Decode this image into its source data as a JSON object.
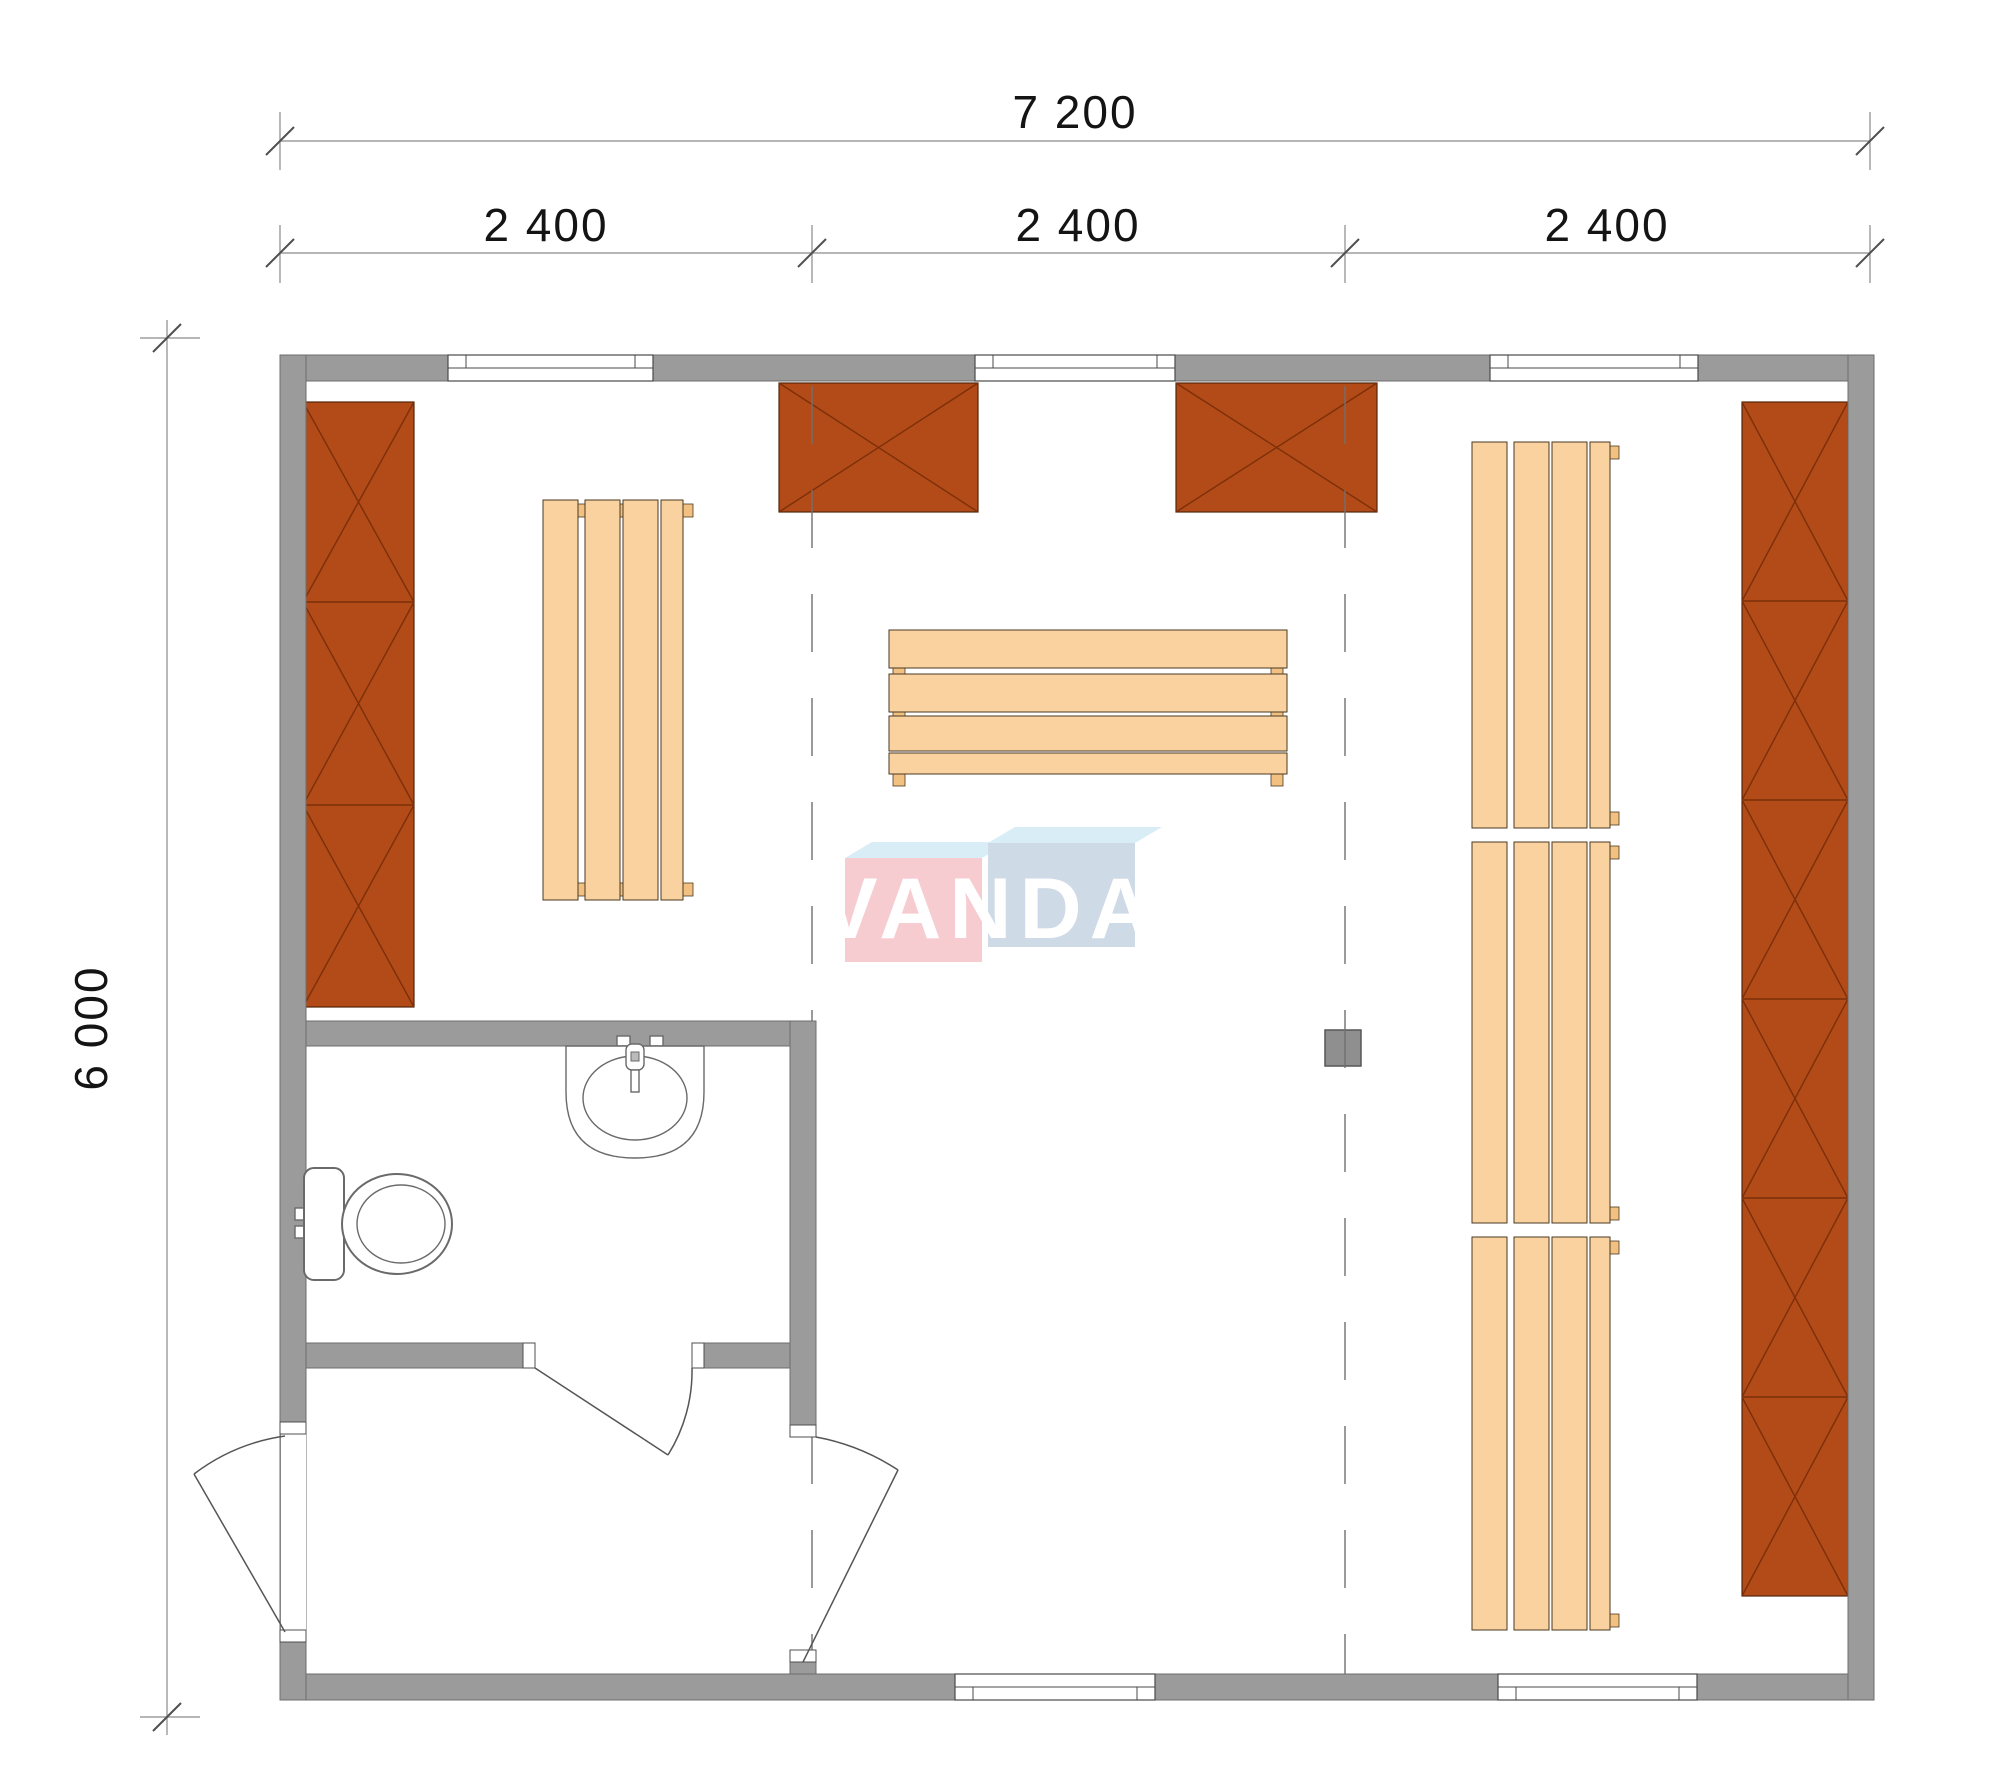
{
  "dimensions": {
    "width_total": "7 200",
    "module_1": "2 400",
    "module_2": "2 400",
    "module_3": "2 400",
    "depth_total": "6 000"
  },
  "watermark": {
    "brand": "VANDA"
  },
  "colors": {
    "wall": "#9b9b9b",
    "wall-edge": "#6e6e6e",
    "cabinet": "#b24b17",
    "cabinet-line": "#7c2f0a",
    "bench": "#fad2a0",
    "bench-tab": "#f2c081",
    "stove": "#8f8f8f",
    "logo-pink": "#f7ccd1",
    "logo-blue": "#cfdae7",
    "logo-top": "#d8edf6",
    "logo-text": "#ffffff"
  }
}
